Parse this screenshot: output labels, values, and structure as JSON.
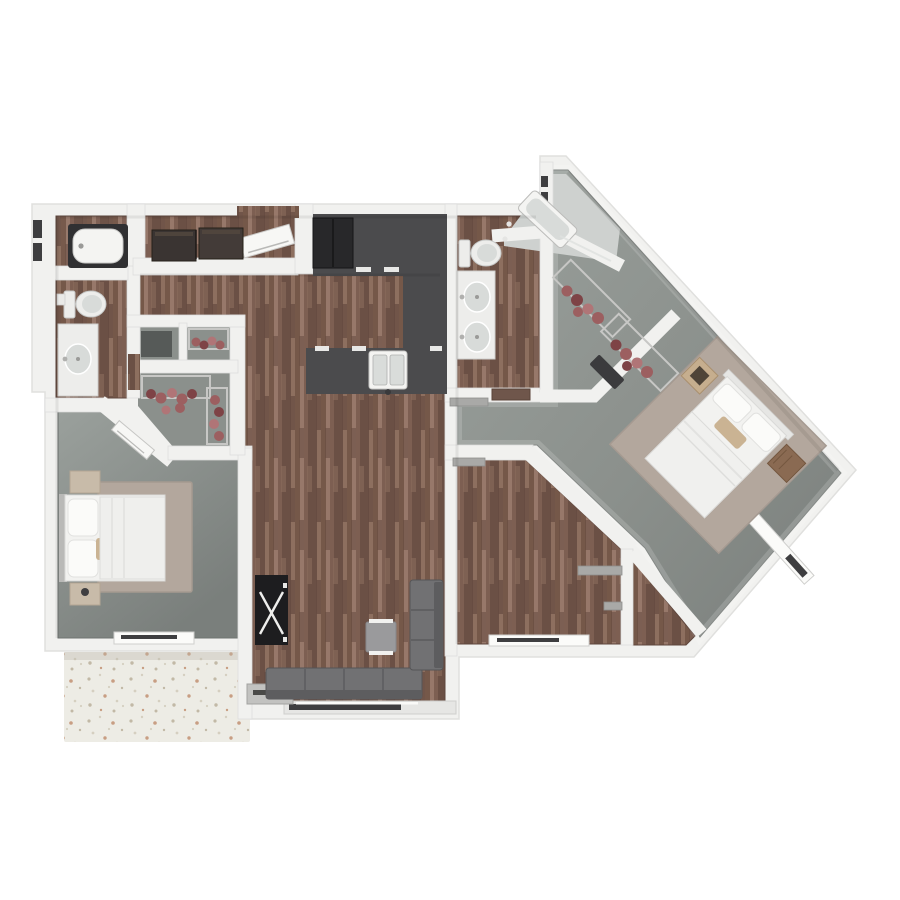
{
  "title": "3d-apartment-floor-plan-top-view",
  "palette": {
    "page_bg": "#ffffff",
    "wall": "#f1f1ef",
    "wall_edge": "#d7d7d5",
    "wall_shade": "#c9c9c7",
    "wood_base": "#7d5f52",
    "wood_dark": "#6b5045",
    "wood_mid": "#755849",
    "wood_light": "#8d6f5f",
    "wood_pale": "#97786a",
    "carpet_light": "#9aa09c",
    "carpet_mid": "#8b908c",
    "carpet_dark": "#7a7f7c",
    "counter": "#4b4b4d",
    "fridge": "#28282a",
    "appliance": "#3a3432",
    "sink_white": "#f4f4f2",
    "sink_basin": "#d9dcda",
    "fixture": "#ededeb",
    "fixture_shade": "#d8dbd9",
    "tub_surround": "#303032",
    "shower_floor": "#ced1cf",
    "sofa": "#717173",
    "sofa_dark": "#5d5d5f",
    "chair": "#9a9a9c",
    "console": "#1d1d1f",
    "clothes_a": "#9c5f60",
    "clothes_b": "#7e4346",
    "clothes_c": "#b07577",
    "rack_metal": "#c7c7c5",
    "bedding": "#f2f2f0",
    "pillow": "#fbfbf9",
    "pillow_accent": "#cab393",
    "rug": "#b3a79d",
    "nightstand_light": "#c8bba9",
    "nightstand_wood": "#8a6a52",
    "art_frame": "#c6ae8e",
    "bench": "#3b3b3d",
    "shelf": "#a9a9a7",
    "window_dark": "#3e3e40",
    "window_white": "#fbfbf9",
    "threshold": "#c2c2c0",
    "door_leaf": "#f7f7f5",
    "door_wood": "#6f564b",
    "patio_base": "#edece5",
    "patio_speck1": "#d5cfc0",
    "patio_speck2": "#c2b9a6",
    "patio_speck3": "#c89e83",
    "headboard": "#b9b9b7"
  },
  "objects": {
    "rooms": [
      "bathroom-1",
      "tub-room",
      "laundry-closet",
      "hallway-foyer",
      "kitchen",
      "great-room",
      "living-room",
      "bedroom-1",
      "closet-small",
      "walk-in-closet-1",
      "master-bathroom",
      "shower-room",
      "walk-in-closet-2",
      "master-corridor",
      "master-bedroom",
      "dining-room",
      "bedroom-hall",
      "patio"
    ],
    "fixtures": [
      "bathtub",
      "toilet",
      "sink-vanity",
      "double-sink-vanity",
      "kitchen-sink",
      "refrigerator",
      "washer",
      "dryer",
      "shower-heads"
    ],
    "furniture": [
      "bed",
      "nightstand",
      "area-rug",
      "sectional-sofa",
      "accent-chair",
      "console-table",
      "clothes-rack",
      "storage-bench",
      "wall-art",
      "wall-shelf"
    ],
    "openings": [
      "front-door",
      "bedroom-door",
      "bathroom-door",
      "sliding-glass-door",
      "window",
      "patio-step"
    ]
  }
}
